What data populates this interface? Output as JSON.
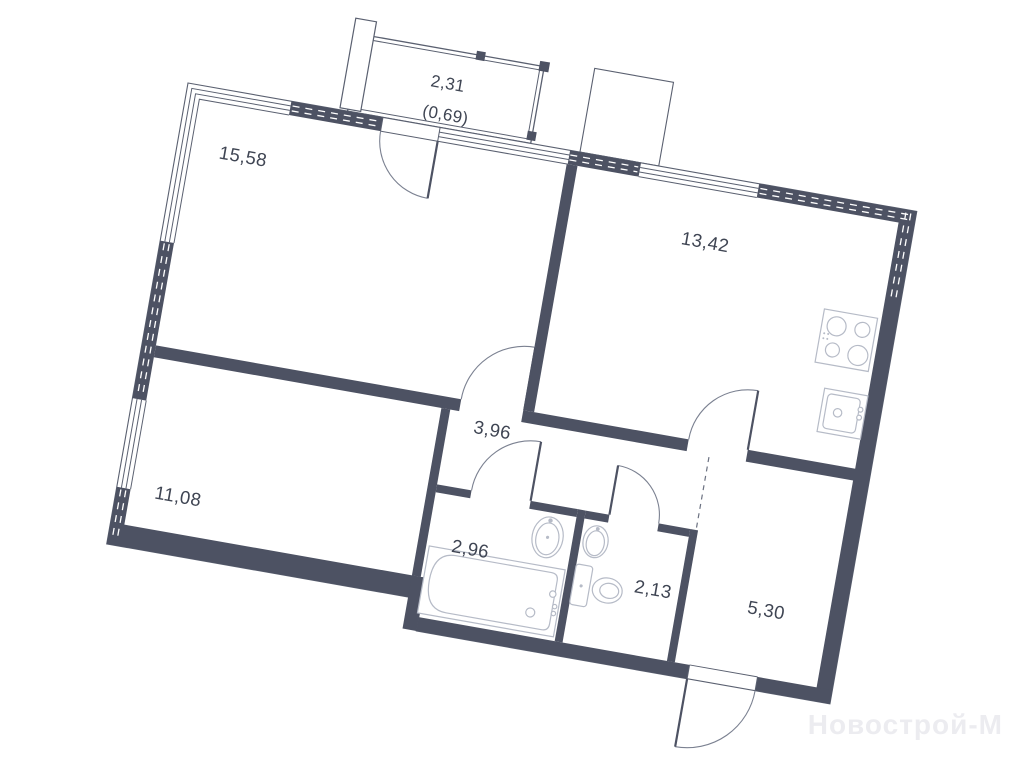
{
  "plan": {
    "type": "apartment-floor-plan",
    "rotation_deg": 10,
    "rooms": [
      {
        "id": "living-room",
        "area_label": "15,58"
      },
      {
        "id": "kitchen",
        "area_label": "13,42"
      },
      {
        "id": "hallway",
        "area_label": "3,96"
      },
      {
        "id": "bedroom",
        "area_label": "11,08"
      },
      {
        "id": "bathroom",
        "area_label": "2,96"
      },
      {
        "id": "wc",
        "area_label": "2,13"
      },
      {
        "id": "entry-hall",
        "area_label": "5,30"
      },
      {
        "id": "balcony",
        "area_label": "2,31",
        "area_label_secondary": "(0,69)"
      }
    ],
    "fixtures": [
      "stove",
      "kitchen-sink",
      "bathtub",
      "bathroom-sink",
      "wc-sink",
      "toilet"
    ],
    "doors": [
      "balcony-door",
      "living-room-door",
      "kitchen-door",
      "bathroom-door",
      "wc-door",
      "entrance-door"
    ],
    "colors": {
      "background": "#ffffff",
      "wall": "#4d5263",
      "thin_line": "#5a6070",
      "door_arc": "#7b8191",
      "fixture_line": "#b6bbc7",
      "label_text": "#3f4553",
      "watermark": "#ececf0",
      "wall_dash": "#ffffff"
    }
  },
  "watermark": {
    "text": "Новострой-М"
  }
}
